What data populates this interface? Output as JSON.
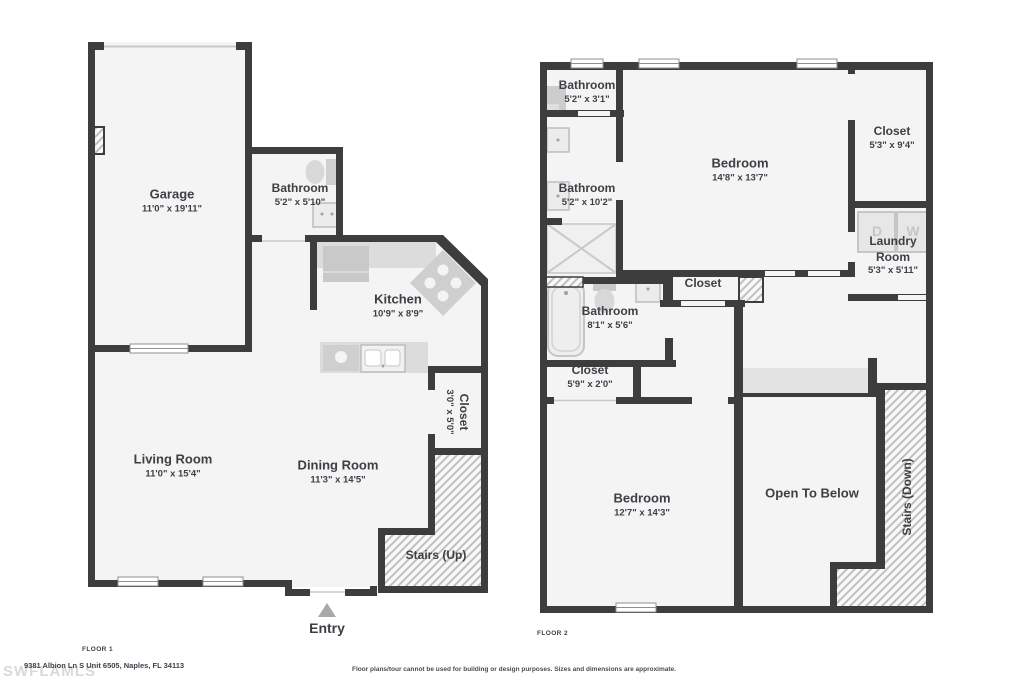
{
  "floor1": {
    "label": "FLOOR 1",
    "rooms": {
      "garage": {
        "name": "Garage",
        "dims": "11'0\" x 19'11\""
      },
      "bathroom": {
        "name": "Bathroom",
        "dims": "5'2\" x 5'10\""
      },
      "kitchen": {
        "name": "Kitchen",
        "dims": "10'9\" x 8'9\""
      },
      "living_room": {
        "name": "Living Room",
        "dims": "11'0\" x 15'4\""
      },
      "dining_room": {
        "name": "Dining Room",
        "dims": "11'3\" x 14'5\""
      },
      "closet": {
        "name": "Closet",
        "dims": "3'0\" x 5'0\""
      },
      "stairs": {
        "name": "Stairs (Up)"
      },
      "entry": {
        "name": "Entry"
      }
    }
  },
  "floor2": {
    "label": "FLOOR 2",
    "rooms": {
      "bathroom_small": {
        "name": "Bathroom",
        "dims": "5'2\" x 3'1\""
      },
      "bathroom_left": {
        "name": "Bathroom",
        "dims": "5'2\" x 10'2\""
      },
      "bedroom_top": {
        "name": "Bedroom",
        "dims": "14'8\" x 13'7\""
      },
      "closet_right": {
        "name": "Closet",
        "dims": "5'3\" x 9'4\""
      },
      "laundry": {
        "name_line1": "Laundry",
        "name_line2": "Room",
        "dims": "5'3\" x 5'11\"",
        "dryer_label": "D",
        "washer_label": "W"
      },
      "closet_mid": {
        "name": "Closet"
      },
      "bathroom_mid": {
        "name": "Bathroom",
        "dims": "8'1\" x 5'6\""
      },
      "closet_left": {
        "name": "Closet",
        "dims": "5'9\" x 2'0\""
      },
      "bedroom_bottom": {
        "name": "Bedroom",
        "dims": "12'7\" x 14'3\""
      },
      "open_below": {
        "name": "Open To Below"
      },
      "stairs": {
        "name": "Stairs (Down)"
      }
    }
  },
  "footer": {
    "address": "9381 Albion Ln S Unit 6505, Naples, FL 34113",
    "watermark": "SWFLAMLS",
    "disclaimer": "Floor plans/tour cannot be used for building or design purposes. Sizes and dimensions are approximate."
  },
  "colors": {
    "wall": "#3d3d3d",
    "room_fill": "#f4f4f4",
    "fixture_gray": "#d6d6d6",
    "hatch_line": "#bfbfbf",
    "label_text": "#3c3f44"
  }
}
